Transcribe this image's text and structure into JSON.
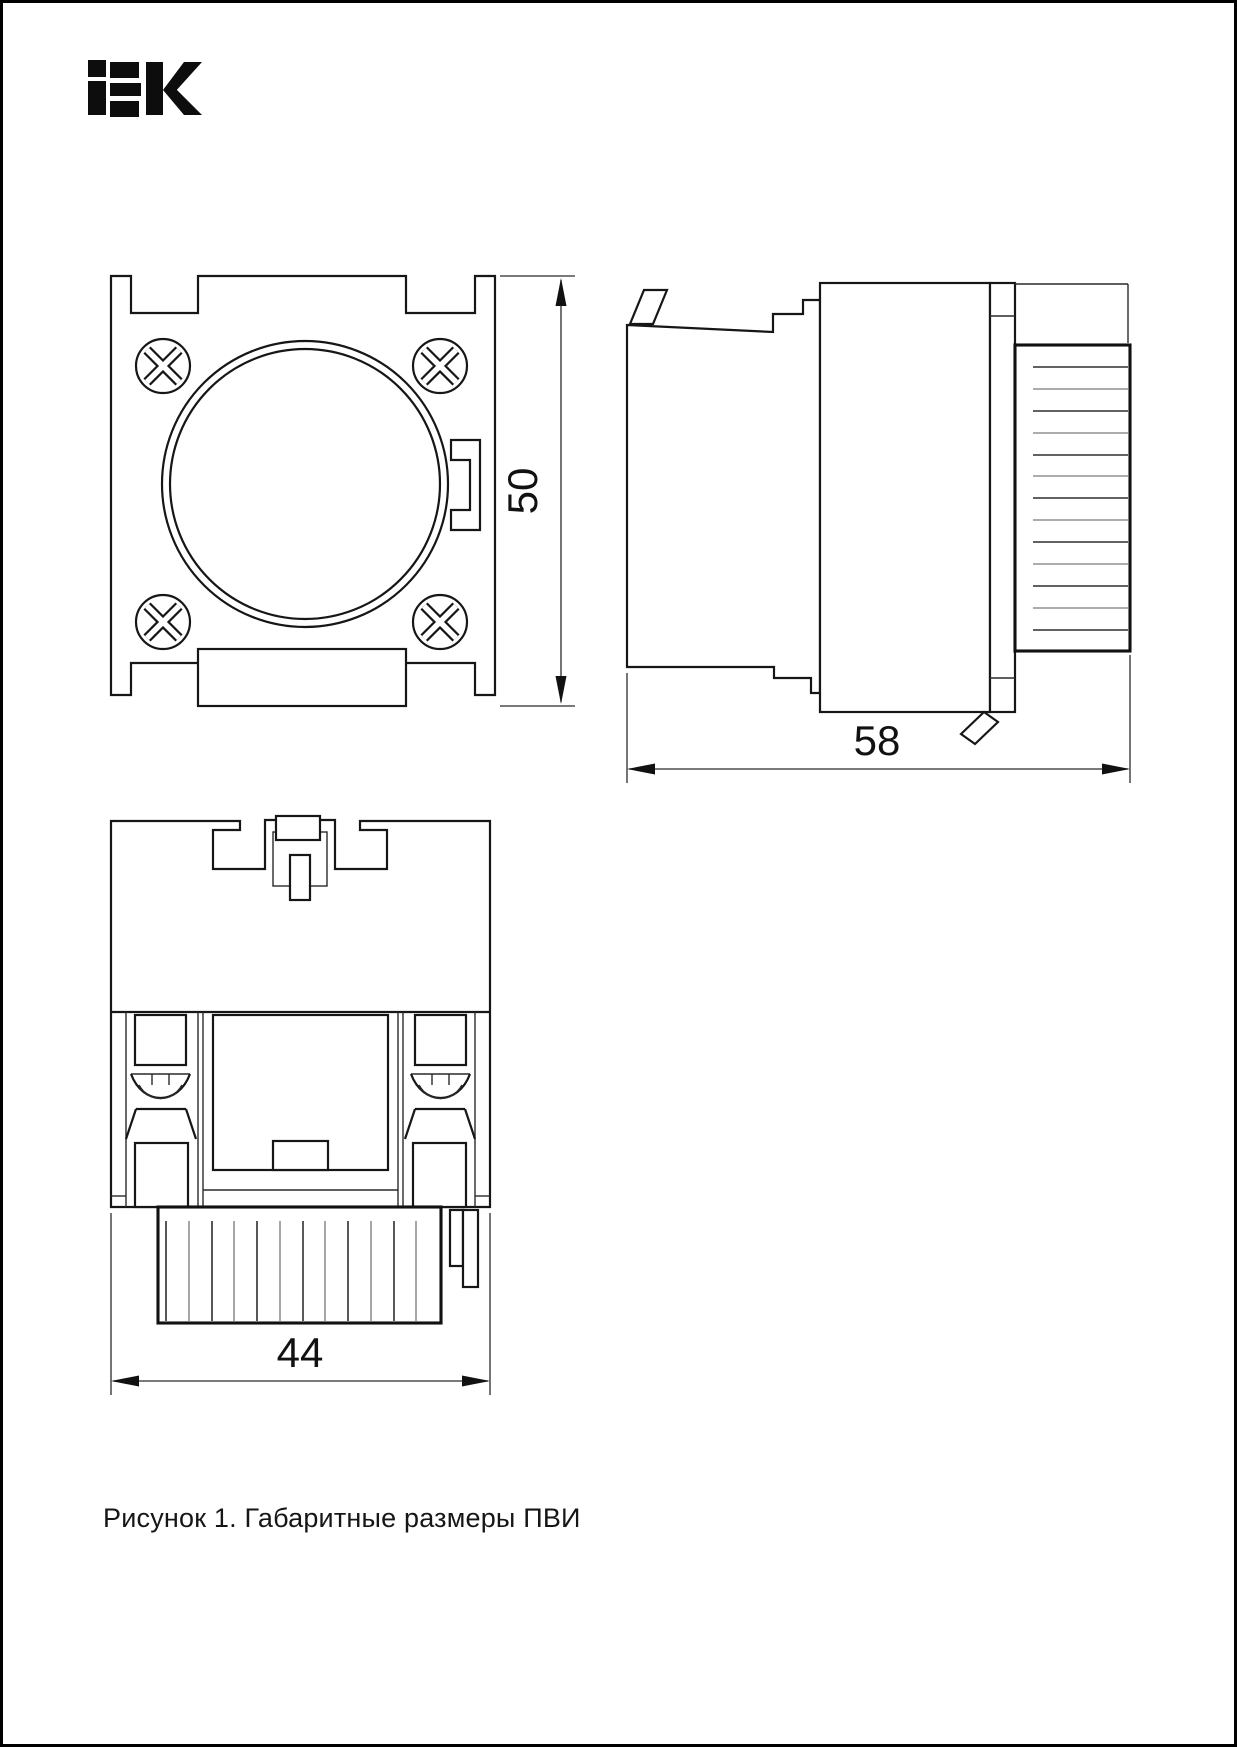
{
  "page": {
    "background": "#ffffff",
    "border_color": "#000000"
  },
  "brand": {
    "logo_text": "IEK",
    "logo_color": "#0d0d0d"
  },
  "figure": {
    "caption": "Рисунок 1. Габаритные размеры ПВИ",
    "line_color": "#1a1a1a",
    "views": [
      {
        "id": "front-view",
        "dimension": {
          "label": "50",
          "orientation": "vertical"
        }
      },
      {
        "id": "side-view",
        "dimension": {
          "label": "58",
          "orientation": "horizontal"
        }
      },
      {
        "id": "bottom-view",
        "dimension": {
          "label": "44",
          "orientation": "horizontal"
        }
      }
    ]
  }
}
